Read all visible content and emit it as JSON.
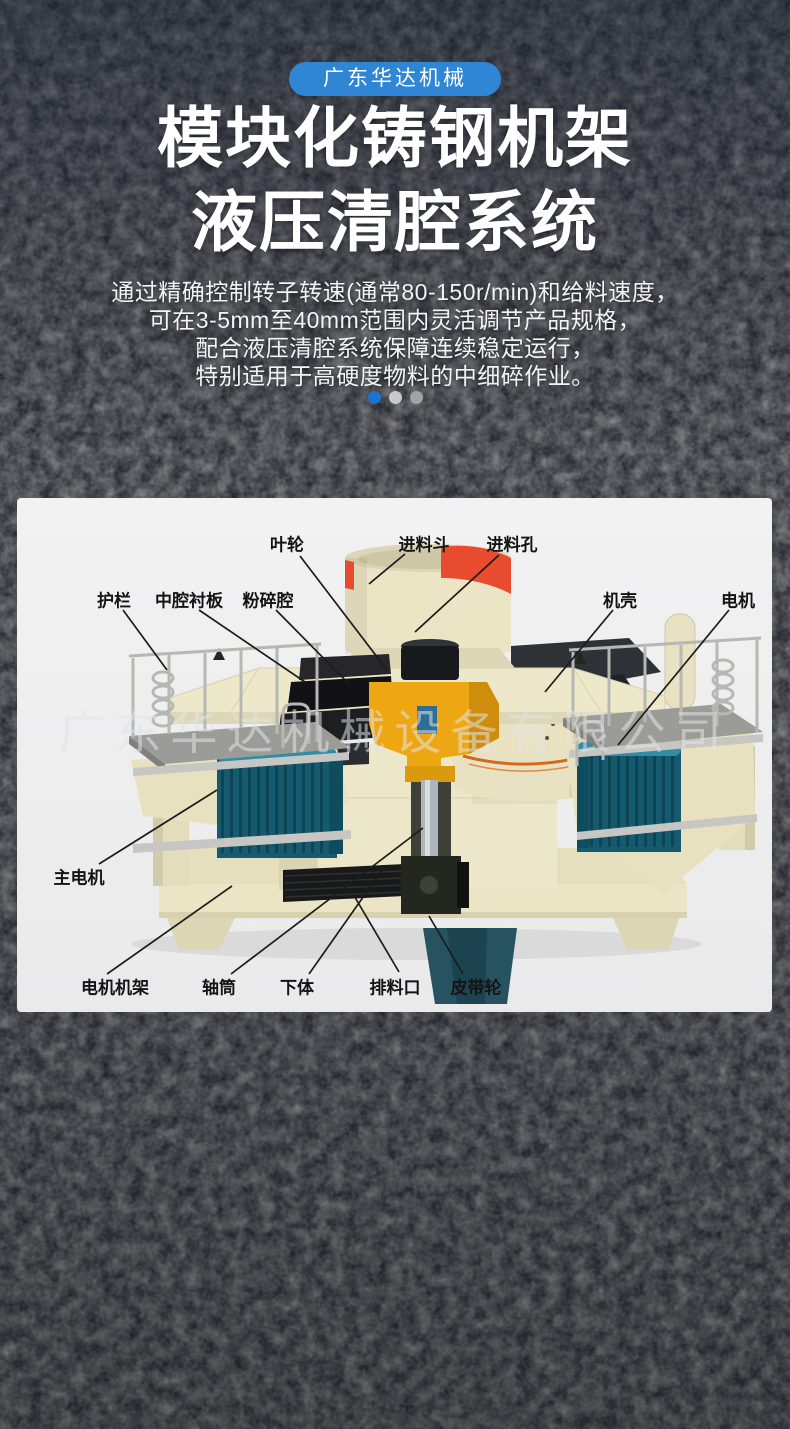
{
  "header": {
    "brand_badge": "广东华达机械",
    "title_line1": "模块化铸钢机架",
    "title_line2": "液压清腔系统",
    "description_lines": [
      "通过精确控制转子转速(通常80-150r/min)和给料速度，",
      "可在3-5mm至40mm范围内灵活调节产品规格，",
      "配合液压清腔系统保障连续稳定运行，",
      "特别适用于高硬度物料的中细碎作业。"
    ],
    "badge_color": "#2e86d4"
  },
  "carousel": {
    "dot_count": 3,
    "active_index": 0,
    "active_color": "#1a73d1",
    "inactive_colors": [
      "#c9c9c9",
      "#a3a3a3"
    ]
  },
  "diagram": {
    "watermark": "广东华达机械设备有限公司",
    "labels": [
      {
        "id": "impeller",
        "text": "叶轮"
      },
      {
        "id": "feed-hopper",
        "text": "进料斗"
      },
      {
        "id": "feed-hole",
        "text": "进料孔"
      },
      {
        "id": "guardrail",
        "text": "护栏"
      },
      {
        "id": "cavity-liner",
        "text": "中腔衬板"
      },
      {
        "id": "crushing-cavity",
        "text": "粉碎腔"
      },
      {
        "id": "casing",
        "text": "机壳"
      },
      {
        "id": "motor",
        "text": "电机"
      },
      {
        "id": "main-motor",
        "text": "主电机"
      },
      {
        "id": "motor-frame",
        "text": "电机机架"
      },
      {
        "id": "shaft-tube",
        "text": "轴筒"
      },
      {
        "id": "lower-body",
        "text": "下体"
      },
      {
        "id": "discharge-port",
        "text": "排料口"
      },
      {
        "id": "belt-pulley",
        "text": "皮带轮"
      }
    ],
    "machine_colors": {
      "body_cream": "#ece6c8",
      "hopper_red": "#e84b2d",
      "rotor_yellow": "#eda712",
      "chamber_black": "#1b1b1b",
      "motor_teal": "#155a6e",
      "deck_gray": "#9b9b97"
    }
  }
}
